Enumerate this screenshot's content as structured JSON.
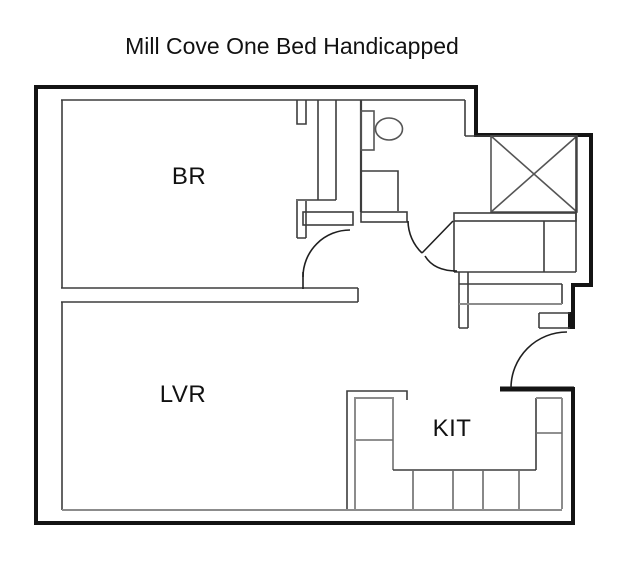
{
  "title": "Mill Cove One Bed Handicapped",
  "rooms": {
    "bedroom": {
      "label": "BR"
    },
    "living_room": {
      "label": "LVR"
    },
    "kitchen": {
      "label": "KIT"
    }
  },
  "fixtures": {
    "toilet": "toilet-icon",
    "sink": "sink-vanity",
    "shaft": "crossed-box-shaft",
    "doors": [
      "bedroom-door",
      "bathroom-door",
      "entry-door"
    ]
  },
  "colors": {
    "wall": "#141414",
    "partition": "#3d3d3d",
    "fixture": "#555555",
    "counter_inner": "#8c8c8c",
    "divider": "#6b6b6b",
    "door": "#1f1f1f",
    "background": "#ffffff",
    "text": "#111111"
  }
}
